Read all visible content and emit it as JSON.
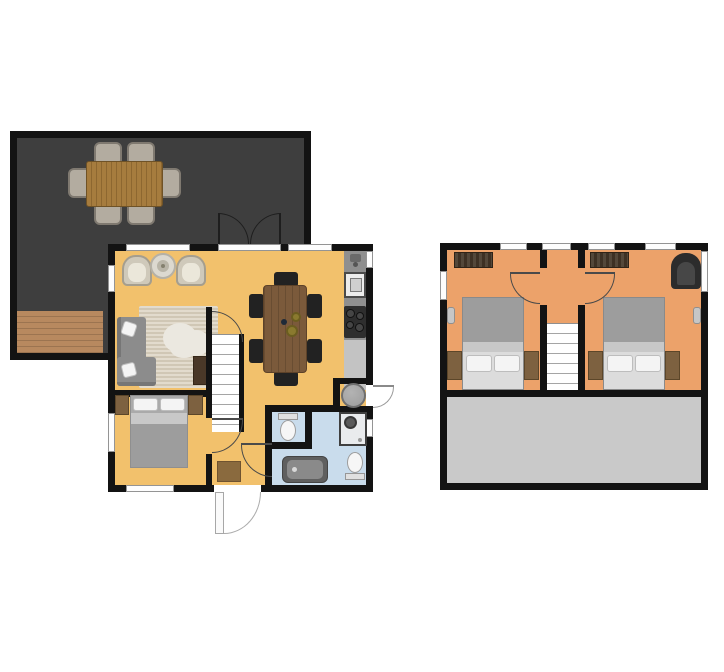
{
  "plan": {
    "label": "two-storey-house-floor-plan",
    "ground_floor": {
      "label": "ground-floor",
      "rooms": [
        "terrace",
        "living-room",
        "kitchen",
        "bedroom",
        "hallway",
        "bathroom",
        "wc",
        "utility-room",
        "staircase"
      ],
      "furniture": [
        "outdoor-dining-table",
        "outdoor-chairs-x6",
        "wood-deck",
        "armchair-x2",
        "plant-side-table",
        "corner-sofa",
        "rug",
        "sheepskin",
        "tv-cabinet",
        "dining-table",
        "dining-chairs-x6",
        "kitchen-counter",
        "faucet",
        "sink",
        "cooktop",
        "double-bed",
        "nightstand-x2",
        "doormat",
        "entry-door",
        "bathtub",
        "shower",
        "toilet-x2",
        "boiler"
      ]
    },
    "upper_floor": {
      "label": "upper-floor",
      "rooms": [
        "bedroom-left",
        "stairwell",
        "bedroom-right",
        "roof-area"
      ],
      "furniture": [
        "dresser-x2",
        "double-bed-x2",
        "nightstand-x4",
        "wall-sconce-x2",
        "armchair",
        "stairs"
      ]
    }
  },
  "colors": {
    "wall": "#131313",
    "terrace": "#3e3e3e",
    "deck": "#b8895f",
    "deck_line": "#9c7450",
    "floor_main": "#f2c16c",
    "floor_upper": "#eca26a",
    "bath": "#c9dcec",
    "gray": "#c9c9c9",
    "counter": "#8f8f8f",
    "counter_light": "#c3c3c3",
    "wood": "#7b5a3b",
    "wood_outdoor": "#a67c3e",
    "chair": "#222222",
    "chair_out": "#b3aca0",
    "cream": "#cfc9ba",
    "cream_light": "#ebe7da",
    "sofa": "#8c8c8c",
    "rug": "#d9cfbc",
    "bed": "#aaaaaa",
    "bed_fold": "#c8c8c8",
    "bed_duvet": "#9d9d9d",
    "pillow": "#f4f4f4",
    "stand": "#7d6140",
    "dresser": "#463829",
    "tub": "#5f5f5f",
    "stairs_line": "#a5a5a5",
    "door": "#4a4a4a",
    "frame": "#949494",
    "boiler": "#9c9c9c",
    "armchair_dark": "#2c2c2c"
  }
}
